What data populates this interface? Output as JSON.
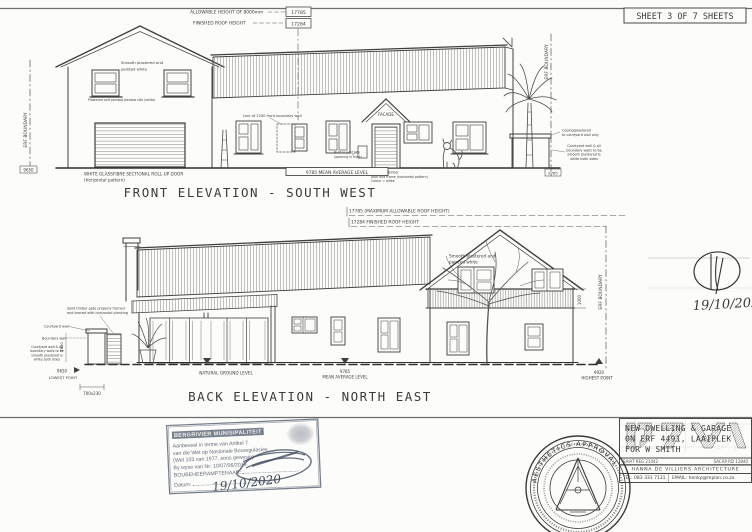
{
  "colors": {
    "ink": "#3f3f3f",
    "paper": "#fcfcfa",
    "stamp_ink": "#6a7482"
  },
  "sheet": {
    "label": "SHEET 3 OF 7 SHEETS"
  },
  "front_elevation": {
    "title": "FRONT ELEVATION - SOUTH WEST",
    "dims": {
      "allowable_height": "ALLOWABLE HEIGHT OF 8000mm",
      "allowable_height_value": "17785",
      "finished_roof": "FINISHED ROOF HEIGHT",
      "finished_roof_value": "17284",
      "mean_average_level": "9785 MEAN AVERAGE LEVEL",
      "level_left": "9650",
      "level_right": "9785",
      "erf_boundary_left": "ERF BOUNDARY",
      "erf_boundary_right": "ERF BOUNDARY"
    },
    "notes": {
      "smooth_plastered": [
        "Smooth plastered and",
        "painted white"
      ],
      "window_sills": "Plastered and painted window sills (white)",
      "garage_door": [
        "WHITE GLASSFIBRE SECTIONAL ROLL-UP DOOR",
        "(horizontal pattern)"
      ],
      "boundary_wall": "Line of 1200 front boundary wall",
      "facade": "FACADE",
      "post_box": [
        "Built-in post box",
        "(opening in front)"
      ],
      "front_door": [
        "900x2100 timber",
        "door and frame (horizontal pattern)",
        "Colour = white"
      ],
      "coping": [
        "Coping/plastered",
        "to courtyard wall only"
      ],
      "courtyard": [
        "Courtyard wall & all",
        "boundary walls to be",
        "smooth plastered &",
        "white both sides"
      ]
    }
  },
  "back_elevation": {
    "title": "BACK ELEVATION - NORTH EAST",
    "dims": {
      "max_roof_height": "17785 (MAXIMUM ALLOWABLE ROOF HEIGHT)",
      "finished_roof": "17284 FINISHED ROOF HEIGHT",
      "lowest_value": "9650",
      "lowest_label": "LOWEST POINT",
      "gate_size": "700x230",
      "wall_height": "1800",
      "natural_ground": "NATURAL GROUND LEVEL",
      "mean_value": "9785",
      "mean_label": "MEAN AVERAGE LEVEL",
      "highest_value": "9920",
      "highest_label": "HIGHEST POINT",
      "balcony_height": "1000",
      "erf_boundary": "ERF BOUNDARY"
    },
    "notes": {
      "gate": [
        "Solid timber gate properly framed",
        "and braced with horizontal planking"
      ],
      "courtyard_wall": "Courtyard wall",
      "boundary_wall": "Boundary wall",
      "courtyard": [
        "Courtyard wall & all",
        "boundary walls to be",
        "smooth plastered &",
        "white both sides"
      ],
      "smooth_plastered": [
        "Smooth plastered and",
        "painted white"
      ]
    }
  },
  "approval": {
    "date": "19/10/2020",
    "stamp": {
      "header": "BERGRIVIER MUNISIPALITEIT",
      "lines": [
        "Aanbeveel in terme van Artikel 7",
        "van die Wet op Nasionale Bouregulasies",
        "(Wet 103 van 1977, soos gewysig)",
        "By wyse van Nr: 10/07/06/2019",
        "BOUBEHEERAMPTENAAR:"
      ],
      "date_label": "Datum:",
      "signed_date": "19/10/2020"
    },
    "seal_text": "AESTHETICS APPROVAL"
  },
  "title_block": {
    "project": [
      "NEW DWELLING & GARAGE",
      "ON ERF 4491, LAAIPLEK",
      "FOR W SMITH"
    ],
    "reg_left": "SAIAT REG 21042",
    "reg_right": "SACAP RD 12840",
    "firm": "HANNA DE VILLIERS ARCHITECTURE",
    "tel": "TEL: 083 333 7131",
    "email": "EMAIL: henkp@mplan.co.za"
  }
}
